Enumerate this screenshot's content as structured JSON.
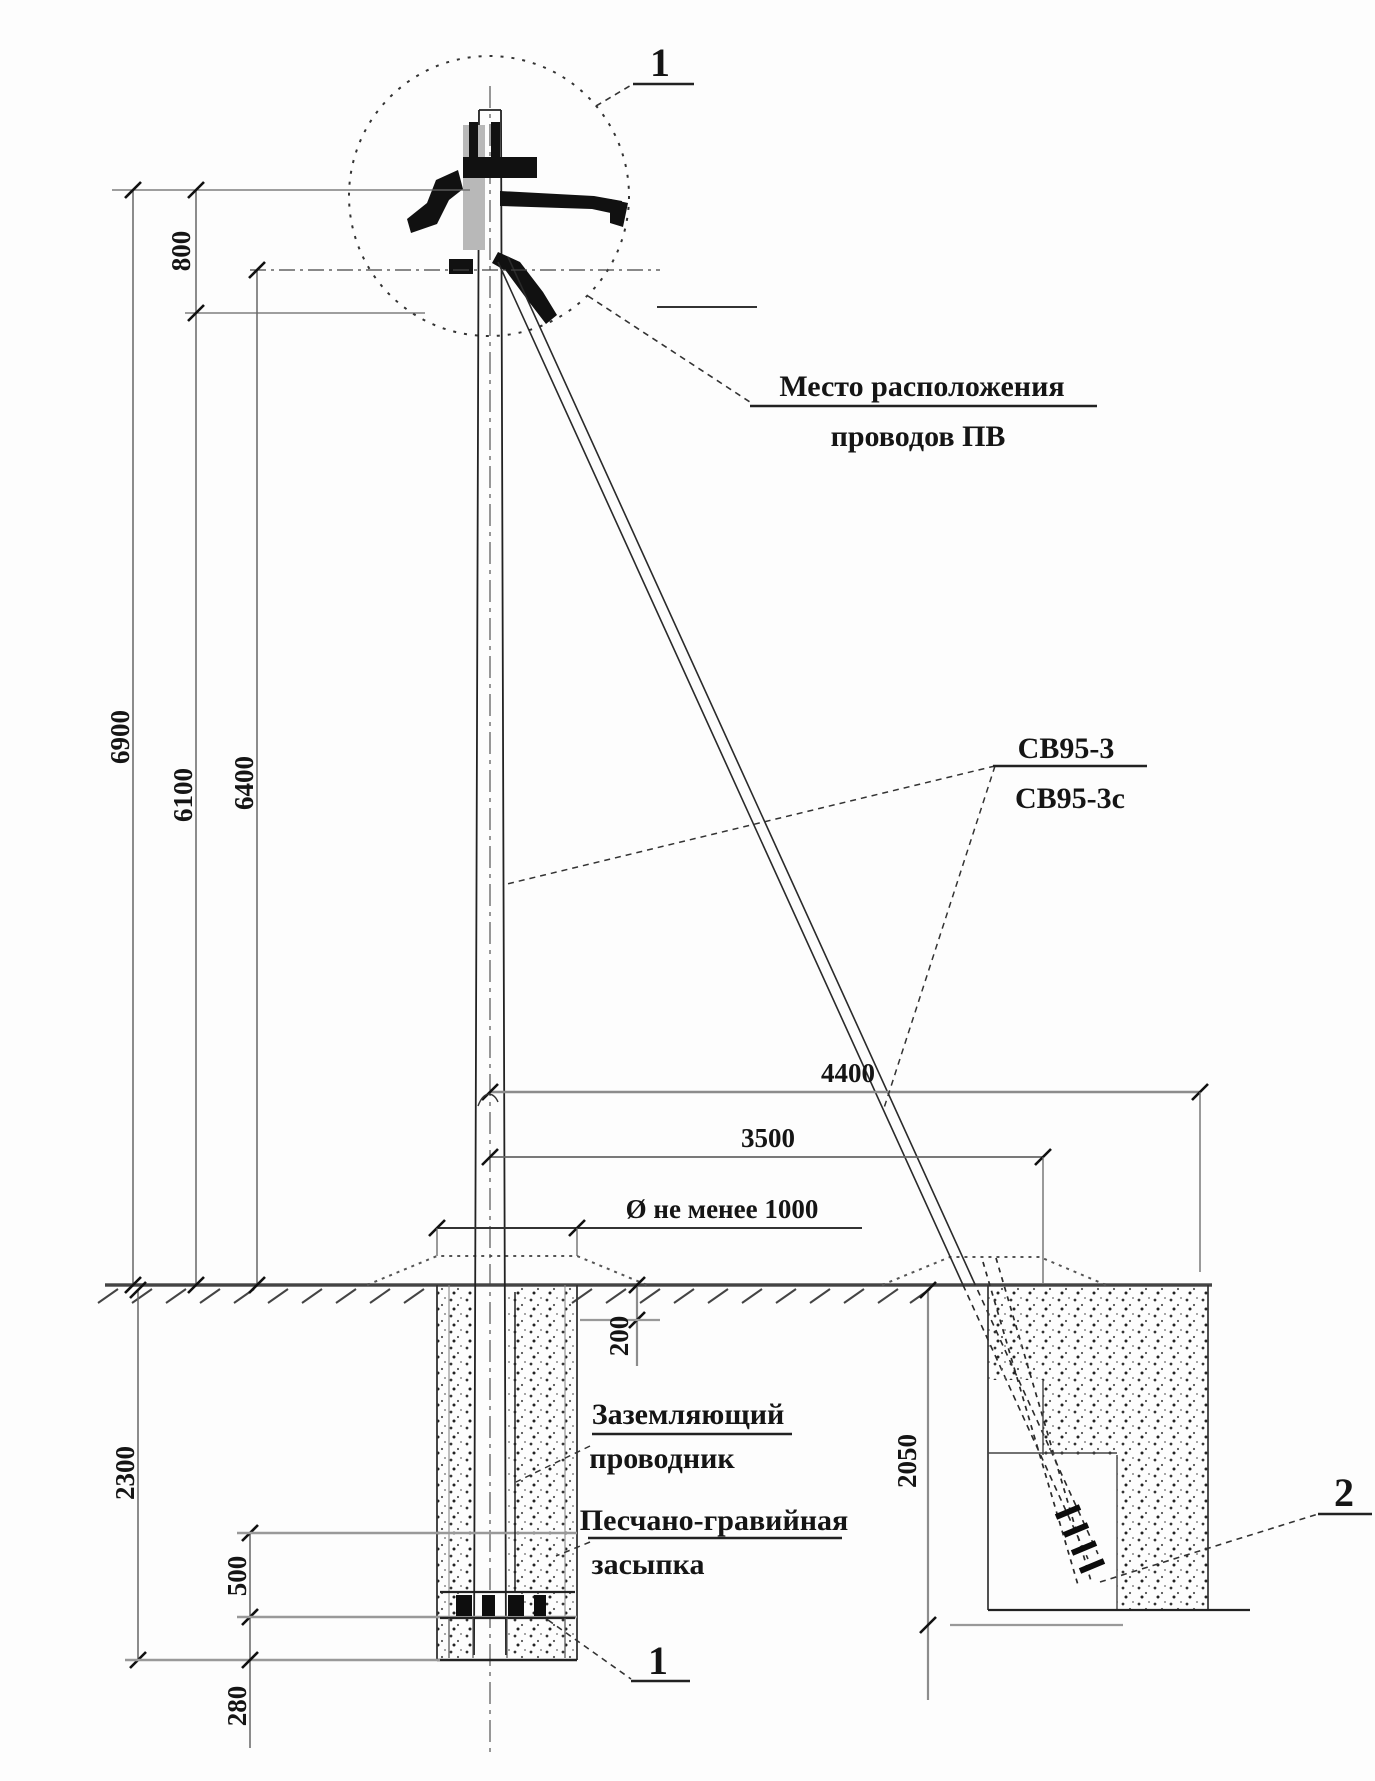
{
  "figure": {
    "detail_callout_top": "1",
    "detail_callout_bottom": "1",
    "detail_callout_anchor": "2",
    "label_wire_location_1": "Место расположения",
    "label_wire_location_2": "проводов ПВ",
    "label_pole_type_1": "СВ95-3",
    "label_pole_type_2": "СВ95-3с",
    "label_grounding_1": "Заземляющий",
    "label_grounding_2": "проводник",
    "label_backfill_1": "Песчано-гравийная",
    "label_backfill_2": "засыпка",
    "dim_800": "800",
    "dim_6900": "6900",
    "dim_6100": "6100",
    "dim_6400": "6400",
    "dim_4400": "4400",
    "dim_3500": "3500",
    "dim_diameter": "Ø не менее 1000",
    "dim_200": "200",
    "dim_2300": "2300",
    "dim_2050": "2050",
    "dim_500": "500",
    "dim_280": "280"
  }
}
